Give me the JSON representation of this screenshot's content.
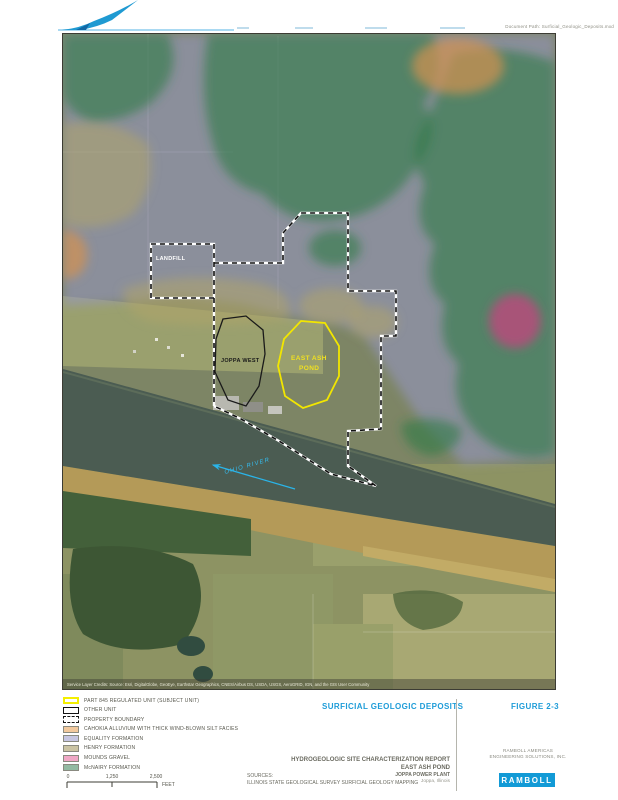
{
  "header": {
    "doc_path_text": "Document Path: Surficial_Geologic_Deposits.mxd"
  },
  "map": {
    "labels": {
      "landfill": "LANDFILL",
      "joppa_west": "JOPPA WEST",
      "east_ash_pond_1": "EAST ASH",
      "east_ash_pond_2": "POND",
      "river": "OHIO RIVER",
      "credits": "Service Layer Credits: Source: Esri, DigitalGlobe, GeoEye, Earthstar Geographics, CNES/Airbus DS, USDA, USGS, AeroGRID, IGN, and the GIS User Community"
    }
  },
  "legend": {
    "items": [
      {
        "label": "PART 845 REGULATED UNIT (SUBJECT UNIT)",
        "swatch": "outline-yellow",
        "color": "#F4EF00"
      },
      {
        "label": "OTHER UNIT",
        "swatch": "outline-black",
        "color": "#111111"
      },
      {
        "label": "PROPERTY BOUNDARY",
        "swatch": "outline-dashed",
        "color": "#111111"
      },
      {
        "label": "CAHOKIA ALLUVIUM WITH THICK WIND-BLOWN SILT FACIES",
        "swatch": "fill",
        "color": "#F2C99E"
      },
      {
        "label": "EQUALITY FORMATION",
        "swatch": "fill",
        "color": "#C6C6E2"
      },
      {
        "label": "HENRY FORMATION",
        "swatch": "fill",
        "color": "#CBC4A4"
      },
      {
        "label": "MOUNDS GRAVEL",
        "swatch": "fill",
        "color": "#F0A8C6"
      },
      {
        "label": "McNAIRY FORMATION",
        "swatch": "fill",
        "color": "#93BAA2"
      }
    ],
    "scale": {
      "tick0": "0",
      "tick1": "1,250",
      "tick2": "2,500",
      "unit": "FEET"
    },
    "sources_title": "SOURCES:",
    "sources_line": "ILLINOIS STATE GEOLOGICAL SURVEY SURFICIAL GEOLOGY MAPPING"
  },
  "titleblock": {
    "map_title": "SURFICIAL GEOLOGIC DEPOSITS",
    "figure_label": "FIGURE 2-3",
    "report_line1": "HYDROGEOLOGIC SITE CHARACTERIZATION REPORT",
    "report_line2": "EAST ASH POND",
    "report_line3": "JOPPA POWER PLANT",
    "report_line4": "Joppa, Illinois",
    "company_line1": "RAMBOLL AMERICAS",
    "company_line2": "ENGINEERING SOLUTIONS, INC.",
    "logo_text": "RAMBOLL",
    "accent_color": "#1E9CD8",
    "logo_color": "#129AD6"
  }
}
